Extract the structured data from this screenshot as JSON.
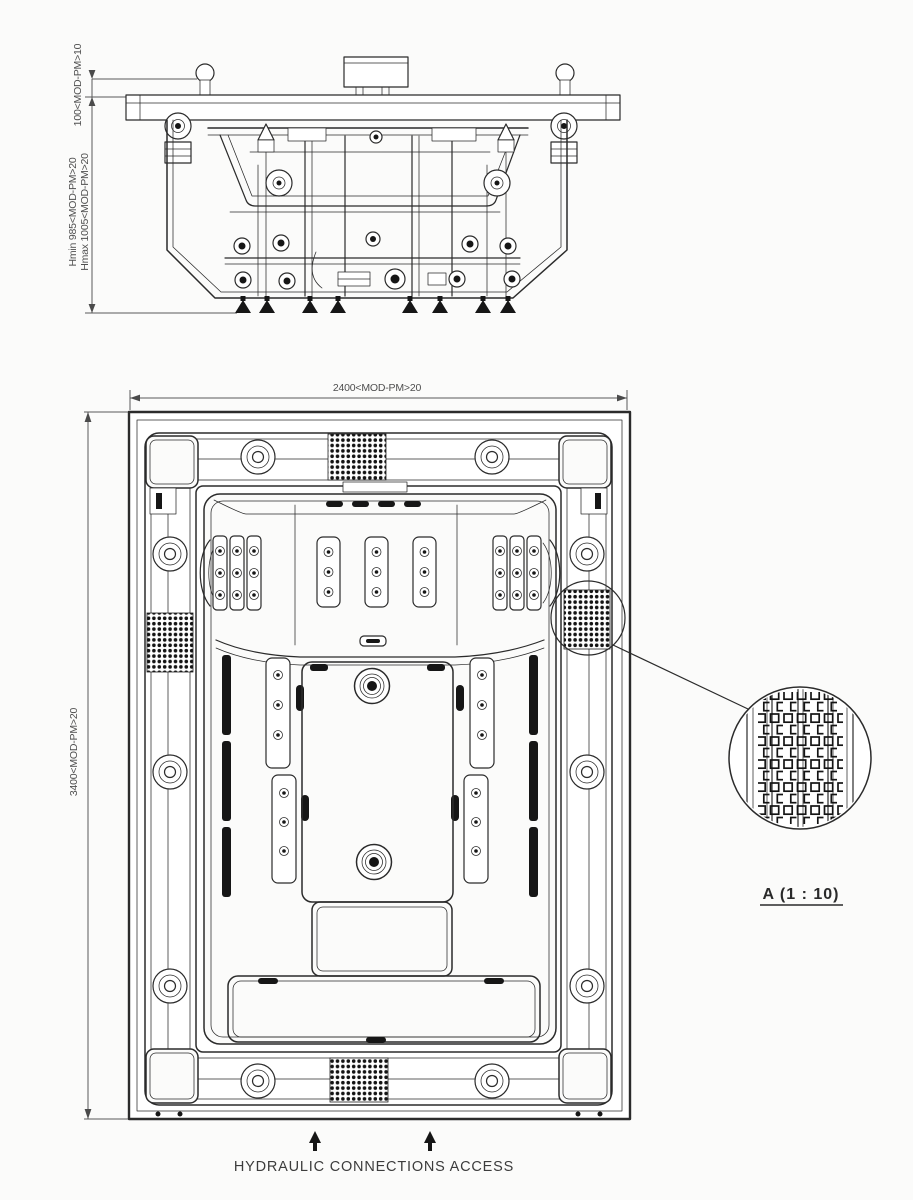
{
  "drawing": {
    "side_view": {
      "dim_top_offset": "100<MOD-PM>10",
      "dim_hmin": "Hmin 985<MOD-PM>20",
      "dim_hmax": "Hmax 1005<MOD-PM>20"
    },
    "plan_view": {
      "dim_width": "2400<MOD-PM>20",
      "dim_length": "3400<MOD-PM>20"
    },
    "detail_view": {
      "label": "A (1 : 10)"
    },
    "footer": {
      "label": "HYDRAULIC CONNECTIONS ACCESS"
    }
  },
  "colors": {
    "line": "#2b2b2b",
    "dim_text": "#4f4f4f",
    "label_text": "#3c3c3c",
    "background": "#fbfbfa",
    "fill_dark": "#161616"
  }
}
